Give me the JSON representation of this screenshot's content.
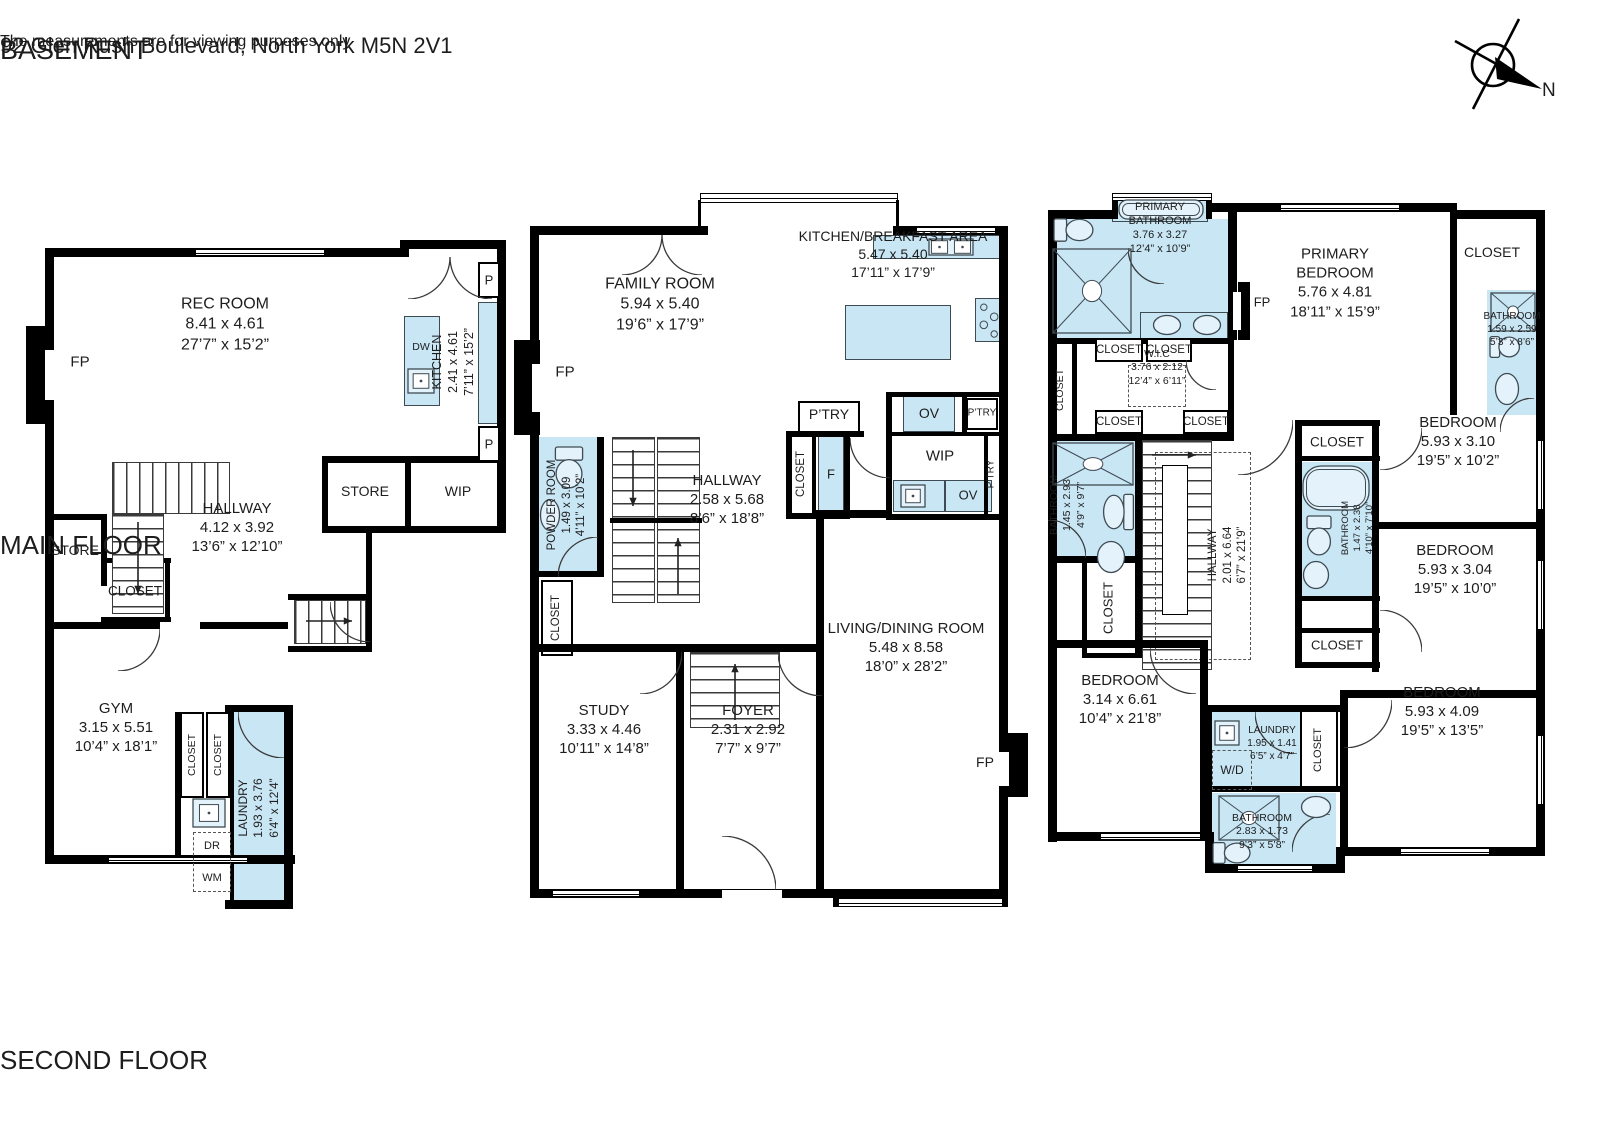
{
  "page": {
    "address": "92 Glen Rush Boulevard, North York M5N 2V1",
    "disclaimer": "The measurements are for viewing purposes only",
    "compass_label": "N"
  },
  "colors": {
    "wall": "#000000",
    "wet_area": "#c9e6f5",
    "background": "#ffffff"
  },
  "floors": {
    "basement": {
      "title": "BASEMENT",
      "rooms": {
        "rec_room": {
          "name": "REC ROOM",
          "metric": "8.41 x 4.61",
          "imperial": "27’7” x 15’2”"
        },
        "kitchen": {
          "name": "KITCHEN",
          "metric": "2.41 x 4.61",
          "imperial": "7’11” x 15’2”"
        },
        "hallway": {
          "name": "HALLWAY",
          "metric": "4.12 x 3.92",
          "imperial": "13’6” x 12’10”"
        },
        "gym": {
          "name": "GYM",
          "metric": "3.15 x 5.51",
          "imperial": "10’4” x 18’1”"
        },
        "laundry": {
          "name": "LAUNDRY",
          "metric": "1.93 x 3.76",
          "imperial": "6’4” x 12’4”"
        }
      },
      "labels": {
        "fp": "FP",
        "store": "STORE",
        "wip": "WIP",
        "closet": "CLOSET",
        "p": "P",
        "dw": "DW",
        "dr": "DR",
        "wm": "WM"
      }
    },
    "main": {
      "title": "MAIN FLOOR",
      "rooms": {
        "family_room": {
          "name": "FAMILY ROOM",
          "metric": "5.94 x 5.40",
          "imperial": "19’6” x 17’9”"
        },
        "kitchen_breakfast": {
          "name": "KITCHEN/BREAKFAST AREA",
          "metric": "5.47 x 5.40",
          "imperial": "17’11” x 17’9”"
        },
        "hallway": {
          "name": "HALLWAY",
          "metric": "2.58 x 5.68",
          "imperial": "8’6” x 18’8”"
        },
        "powder_room": {
          "name": "POWDER ROOM",
          "metric": "1.49 x 3.09",
          "imperial": "4’11” x 10’2”"
        },
        "study": {
          "name": "STUDY",
          "metric": "3.33 x 4.46",
          "imperial": "10’11” x 14’8”"
        },
        "foyer": {
          "name": "FOYER",
          "metric": "2.31 x 2.92",
          "imperial": "7’7” x 9’7”"
        },
        "living_dining": {
          "name": "LIVING/DINING ROOM",
          "metric": "5.48 x 8.58",
          "imperial": "18’0” x 28’2”"
        }
      },
      "labels": {
        "fp": "FP",
        "ptry": "P’TRY",
        "closet": "CLOSET",
        "f": "F",
        "ov": "OV",
        "wip": "WIP"
      }
    },
    "second": {
      "title": "SECOND FLOOR",
      "rooms": {
        "primary_bathroom": {
          "name": "PRIMARY BATHROOM",
          "metric": "3.76 x 3.27",
          "imperial": "12’4” x 10’9”"
        },
        "primary_bedroom": {
          "name": "PRIMARY BEDROOM",
          "metric": "5.76 x 4.81",
          "imperial": "18’11” x 15’9”"
        },
        "bathroom_ensuite": {
          "name": "BATHROOM",
          "metric": "1.59 x 2.59",
          "imperial": "5’3” x 8’6”"
        },
        "wic": {
          "name": "W.I.C",
          "metric": "3.76 x 2.12",
          "imperial": "12’4” x 6’11”"
        },
        "bathroom_left": {
          "name": "BATHROOM",
          "metric": "1.45 x 2.93",
          "imperial": "4’9” x 9’7”"
        },
        "hallway": {
          "name": "HALLWAY",
          "metric": "2.01 x 6.64",
          "imperial": "6’7” x 21’9”"
        },
        "bedroom_1": {
          "name": "BEDROOM",
          "metric": "5.93 x 3.10",
          "imperial": "19’5” x 10’2”"
        },
        "bathroom_mid": {
          "name": "BATHROOM",
          "metric": "1.47 x 2.38",
          "imperial": "4’10” x 7’10”"
        },
        "bedroom_2": {
          "name": "BEDROOM",
          "metric": "5.93 x 3.04",
          "imperial": "19’5” x 10’0”"
        },
        "bedroom_3": {
          "name": "BEDROOM",
          "metric": "3.14 x 6.61",
          "imperial": "10’4” x 21’8”"
        },
        "laundry": {
          "name": "LAUNDRY",
          "metric": "1.95 x 1.41",
          "imperial": "6’5” x 4’7”"
        },
        "bathroom_bottom": {
          "name": "BATHROOM",
          "metric": "2.83 x 1.73",
          "imperial": "9’3” x 5’8”"
        },
        "bedroom_4": {
          "name": "BEDROOM",
          "metric": "5.93 x 4.09",
          "imperial": "19’5” x 13’5”"
        }
      },
      "labels": {
        "closet": "CLOSET",
        "fp": "FP",
        "wd": "W/D"
      }
    }
  }
}
